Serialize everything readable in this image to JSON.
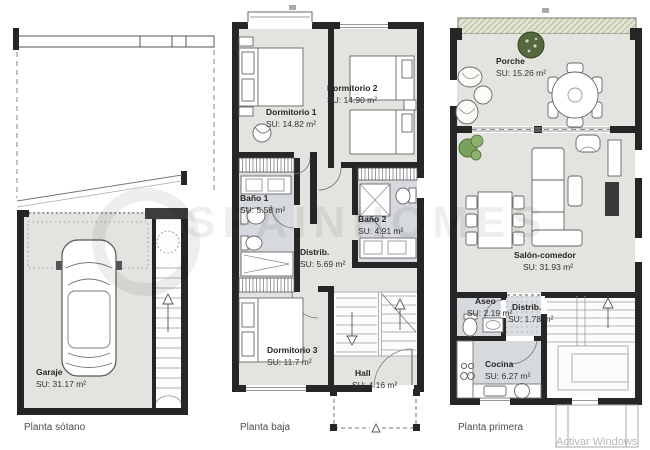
{
  "watermark": {
    "brand": "SPAINHOMES",
    "activar": "Activar Windows"
  },
  "colors": {
    "floor": "#e3e4df",
    "wet_room": "#d6d9dd",
    "wall": "#262626",
    "pergola": "#e2e5d2",
    "plant_green": "#7aa05c"
  },
  "plans": [
    {
      "id": "sotano",
      "title": "Planta sótano",
      "rooms": [
        {
          "name": "Garaje",
          "area": "SU: 31.17 m²"
        }
      ]
    },
    {
      "id": "baja",
      "title": "Planta baja",
      "rooms": [
        {
          "name": "Dormitorio 1",
          "area": "SU: 14.82 m²"
        },
        {
          "name": "Dormitorio 2",
          "area": "SU: 14.90 m²"
        },
        {
          "name": "Baño 1",
          "area": "SU: 5.58 m²"
        },
        {
          "name": "Distrib.",
          "area": "SU: 5.69 m²"
        },
        {
          "name": "Baño 2",
          "area": "SU: 4.91 m²"
        },
        {
          "name": "Dormitorio 3",
          "area": "SU: 11.7 m²"
        },
        {
          "name": "Hall",
          "area": "SU: 4.16 m²"
        }
      ]
    },
    {
      "id": "primera",
      "title": "Planta primera",
      "rooms": [
        {
          "name": "Porche",
          "area": "SU: 15.26 m²"
        },
        {
          "name": "Salón-comedor",
          "area": "SU: 31.93 m²"
        },
        {
          "name": "Aseo",
          "area": "SU: 2.19 m²"
        },
        {
          "name": "Distrib.",
          "area": "SU: 1.78 m²"
        },
        {
          "name": "Cocina",
          "area": "SU: 6.27 m²"
        }
      ]
    }
  ]
}
